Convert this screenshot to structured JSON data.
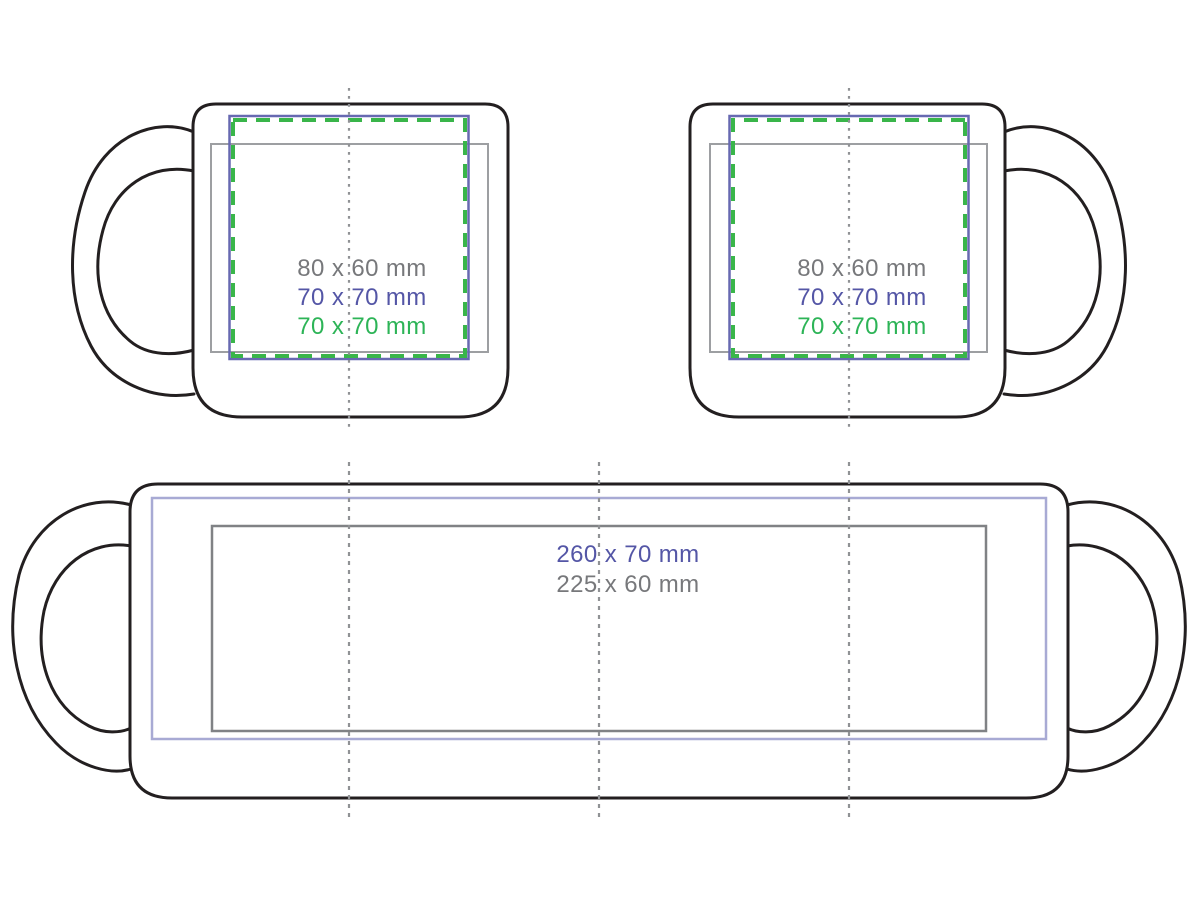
{
  "print_areas": {
    "side_labels": [
      {
        "text": "80 x 60 mm"
      },
      {
        "text": "70 x 70 mm"
      },
      {
        "text": "70 x 70 mm"
      }
    ],
    "wrap_labels": [
      {
        "text": "260 x 70 mm"
      },
      {
        "text": "225 x 60 mm"
      }
    ]
  },
  "colors": {
    "outline": "#231f20",
    "text_gray": "#77787b",
    "text_purple": "#5456a6",
    "text_green": "#2db457",
    "area_gray_side": "#9d9fa2",
    "area_purple_side": "#6769b1",
    "area_green_dashed": "#39b54a",
    "area_purple_wrap": "#a8aad4",
    "area_gray_wrap": "#808285",
    "guide_dotted": "#909295"
  }
}
